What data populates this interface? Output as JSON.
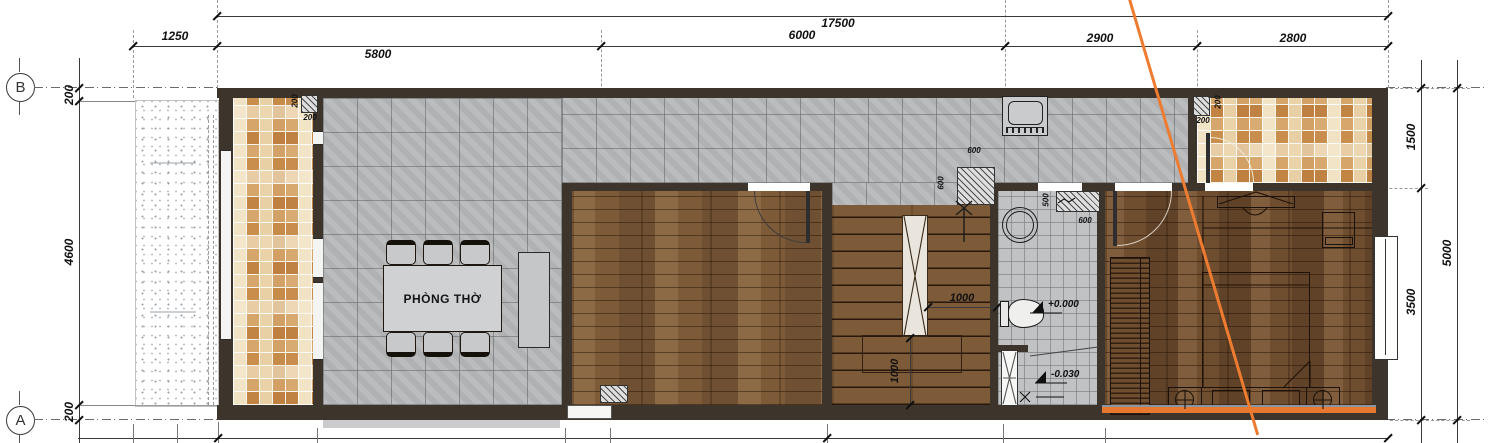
{
  "drawing": {
    "room_label": "PHÒNG THỜ",
    "grid_rows": [
      "B",
      "A"
    ],
    "dimensions": {
      "top_total": "17500",
      "top_segments": [
        "1250",
        "5800",
        "6000",
        "2900",
        "2800"
      ],
      "left_segments": [
        "200",
        "4600",
        "200"
      ],
      "right_segments": [
        "1500",
        "3500"
      ],
      "right_total": "5000",
      "wall_niche_left": [
        "200",
        "200"
      ],
      "kitchen_shaft": [
        "600",
        "600"
      ],
      "bath_counter": [
        "500",
        "600"
      ],
      "stair": [
        "1000",
        "1000"
      ],
      "wall_niche_right": [
        "200",
        "200"
      ]
    },
    "levels": {
      "ground": "+0.000",
      "bath": "-0.030"
    },
    "colors": {
      "section_line": "#ED7D31",
      "wall": "#3D342C",
      "wood_floor": "#7B5937",
      "wood_floor_dark": "#6F4D2F",
      "tile_gray": "#B6B8BA",
      "mosaic": "#D19A5D",
      "threshold_strip": "#E8782F"
    }
  }
}
